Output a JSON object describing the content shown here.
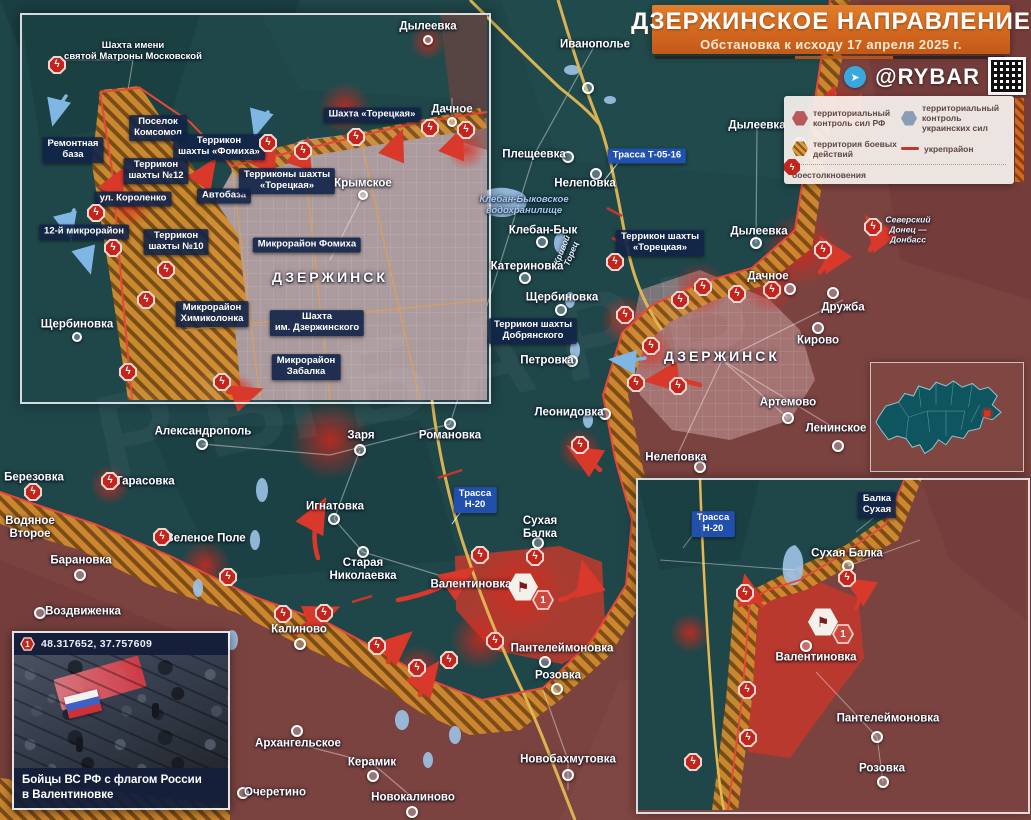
{
  "header": {
    "title": "ДЗЕРЖИНСКОЕ НАПРАВЛЕНИЕ",
    "subtitle": "Обстановка к исходу 17 апреля 2025 г.",
    "brand": "@RYBAR",
    "telegram_icon": "➤"
  },
  "colors": {
    "rf_zone": "#7b4340",
    "ua_zone": "#1d4346",
    "battle_zone": "#d28c2e",
    "clash_red": "#c3251c",
    "chip_navy": "#112348",
    "road_blue": "#2250b2",
    "banner_orange": "#d2671f"
  },
  "legend": {
    "rf": "территориальный контроль сил РФ",
    "ua": "территориальный контроль украинских сил",
    "battle": "территория боевых действий",
    "fort": "укрепрайон",
    "clash": "боестолкновения",
    "bolt": "ϟ"
  },
  "watermark": "РЫБАРЬ",
  "main_map": {
    "labels": [
      {
        "t": "Иванополье",
        "x": 595,
        "y": 45,
        "k": "town"
      },
      {
        "t": "Дылеевка",
        "x": 757,
        "y": 126,
        "k": "town"
      },
      {
        "t": "Трасса Т-05-16",
        "x": 647,
        "y": 156,
        "k": "road"
      },
      {
        "t": "Плещеевка",
        "x": 534,
        "y": 155,
        "k": "town"
      },
      {
        "t": "Нелеповка",
        "x": 585,
        "y": 184,
        "k": "town"
      },
      {
        "t": "Клебан-Быковское\nводохранилище",
        "x": 524,
        "y": 206,
        "k": "riverb"
      },
      {
        "t": "Клебан-Бык",
        "x": 543,
        "y": 231,
        "k": "town"
      },
      {
        "t": "Кривой\nТорец",
        "x": 567,
        "y": 252,
        "k": "river",
        "r": -68
      },
      {
        "t": "Катериновка",
        "x": 527,
        "y": 267,
        "k": "town"
      },
      {
        "t": "Щербиновка",
        "x": 562,
        "y": 298,
        "k": "town"
      },
      {
        "t": "Террикон шахты\nДобрянского",
        "x": 533,
        "y": 331,
        "k": "chip"
      },
      {
        "t": "Петровка",
        "x": 547,
        "y": 361,
        "k": "town"
      },
      {
        "t": "Террикон шахты\n«Торецкая»",
        "x": 660,
        "y": 243,
        "k": "chip"
      },
      {
        "t": "Дылеевка",
        "x": 759,
        "y": 232,
        "k": "town"
      },
      {
        "t": "Дачное",
        "x": 768,
        "y": 277,
        "k": "town"
      },
      {
        "t": "Северский\nДонец —\nДонбасс",
        "x": 908,
        "y": 230,
        "k": "river"
      },
      {
        "t": "ДЗЕРЖИНСК",
        "x": 722,
        "y": 356,
        "k": "caps"
      },
      {
        "t": "Дружба",
        "x": 843,
        "y": 308,
        "k": "town"
      },
      {
        "t": "Кирово",
        "x": 818,
        "y": 341,
        "k": "town"
      },
      {
        "t": "Артемово",
        "x": 788,
        "y": 403,
        "k": "town"
      },
      {
        "t": "Ленинское",
        "x": 836,
        "y": 429,
        "k": "town"
      },
      {
        "t": "Леонидовка",
        "x": 569,
        "y": 413,
        "k": "town"
      },
      {
        "t": "Нелеповка",
        "x": 676,
        "y": 458,
        "k": "town"
      },
      {
        "t": "Александрополь",
        "x": 203,
        "y": 432,
        "k": "town"
      },
      {
        "t": "Березовка",
        "x": 34,
        "y": 478,
        "k": "town"
      },
      {
        "t": "Тарасовка",
        "x": 145,
        "y": 482,
        "k": "town"
      },
      {
        "t": "Водяное\nВторое",
        "x": 30,
        "y": 528,
        "k": "town"
      },
      {
        "t": "Зеленое Поле",
        "x": 206,
        "y": 539,
        "k": "town"
      },
      {
        "t": "Барановка",
        "x": 81,
        "y": 561,
        "k": "town"
      },
      {
        "t": "Воздвиженка",
        "x": 83,
        "y": 612,
        "k": "town"
      },
      {
        "t": "Заря",
        "x": 361,
        "y": 436,
        "k": "town"
      },
      {
        "t": "Романовка",
        "x": 450,
        "y": 436,
        "k": "town"
      },
      {
        "t": "Трасса\nН-20",
        "x": 475,
        "y": 500,
        "k": "road"
      },
      {
        "t": "Игнатовка",
        "x": 335,
        "y": 507,
        "k": "town"
      },
      {
        "t": "Сухая\nБалка",
        "x": 540,
        "y": 528,
        "k": "town"
      },
      {
        "t": "Старая\nНиколаевка",
        "x": 363,
        "y": 570,
        "k": "town"
      },
      {
        "t": "Валентиновка",
        "x": 471,
        "y": 585,
        "k": "town"
      },
      {
        "t": "Пантелеймоновка",
        "x": 562,
        "y": 649,
        "k": "town"
      },
      {
        "t": "Калиново",
        "x": 299,
        "y": 630,
        "k": "town"
      },
      {
        "t": "Розовка",
        "x": 558,
        "y": 676,
        "k": "town"
      },
      {
        "t": "Архангельское",
        "x": 298,
        "y": 744,
        "k": "town"
      },
      {
        "t": "Керамик",
        "x": 372,
        "y": 763,
        "k": "town"
      },
      {
        "t": "Очеретино",
        "x": 275,
        "y": 793,
        "k": "town"
      },
      {
        "t": "Новокалиново",
        "x": 413,
        "y": 798,
        "k": "town"
      },
      {
        "t": "Новобахмутовка",
        "x": 568,
        "y": 760,
        "k": "town"
      }
    ],
    "dots": [
      [
        588,
        88
      ],
      [
        800,
        143
      ],
      [
        568,
        157
      ],
      [
        596,
        174
      ],
      [
        542,
        242
      ],
      [
        525,
        278
      ],
      [
        561,
        310
      ],
      [
        572,
        361
      ],
      [
        605,
        414
      ],
      [
        700,
        467
      ],
      [
        790,
        289
      ],
      [
        756,
        243
      ],
      [
        833,
        293
      ],
      [
        818,
        328
      ],
      [
        788,
        418
      ],
      [
        838,
        446
      ],
      [
        202,
        444
      ],
      [
        360,
        450
      ],
      [
        450,
        424
      ],
      [
        334,
        519
      ],
      [
        538,
        543
      ],
      [
        363,
        552
      ],
      [
        300,
        644
      ],
      [
        557,
        689
      ],
      [
        297,
        731
      ],
      [
        373,
        776
      ],
      [
        243,
        793
      ],
      [
        412,
        812
      ],
      [
        568,
        775
      ],
      [
        80,
        575
      ],
      [
        40,
        613
      ],
      [
        545,
        662
      ]
    ],
    "clashes": [
      [
        615,
        262
      ],
      [
        625,
        315
      ],
      [
        651,
        346
      ],
      [
        680,
        300
      ],
      [
        703,
        287
      ],
      [
        737,
        294
      ],
      [
        772,
        290
      ],
      [
        823,
        250
      ],
      [
        873,
        227
      ],
      [
        636,
        383
      ],
      [
        678,
        386
      ],
      [
        580,
        445
      ],
      [
        33,
        492
      ],
      [
        110,
        481
      ],
      [
        162,
        537
      ],
      [
        228,
        577
      ],
      [
        283,
        614
      ],
      [
        324,
        613
      ],
      [
        377,
        646
      ],
      [
        417,
        668
      ],
      [
        449,
        660
      ],
      [
        495,
        641
      ],
      [
        480,
        555
      ],
      [
        535,
        557
      ]
    ],
    "flag_marker": {
      "x": 523,
      "y": 587,
      "glyph": "⚑"
    },
    "num_marker": {
      "x": 543,
      "y": 600,
      "t": "1"
    }
  },
  "inset_city": {
    "labels": [
      {
        "t": "Шахта имени\nсвятой Матроны Московской",
        "x": 133,
        "y": 52,
        "k": "townsm"
      },
      {
        "t": "Поселок\nКомсомол",
        "x": 158,
        "y": 128,
        "k": "chip"
      },
      {
        "t": "Ремонтная\nбаза",
        "x": 73,
        "y": 150,
        "k": "chip"
      },
      {
        "t": "Террикон\nшахты «Фомиха»",
        "x": 219,
        "y": 147,
        "k": "chip"
      },
      {
        "t": "Террикон\nшахты №12",
        "x": 156,
        "y": 171,
        "k": "chip"
      },
      {
        "t": "ул. Короленко",
        "x": 133,
        "y": 199,
        "k": "chip"
      },
      {
        "t": "Автобаза",
        "x": 224,
        "y": 196,
        "k": "chip"
      },
      {
        "t": "12-й микрорайон",
        "x": 84,
        "y": 232,
        "k": "chip"
      },
      {
        "t": "Террикон\nшахты №10",
        "x": 176,
        "y": 242,
        "k": "chip"
      },
      {
        "t": "Терриконы шахты\n«Торецкая»",
        "x": 287,
        "y": 181,
        "k": "chip"
      },
      {
        "t": "Шахта «Торецкая»",
        "x": 372,
        "y": 115,
        "k": "chip"
      },
      {
        "t": "Микрорайон Фомиха",
        "x": 307,
        "y": 245,
        "k": "chip"
      },
      {
        "t": "Крымское",
        "x": 363,
        "y": 184,
        "k": "town"
      },
      {
        "t": "Дачное",
        "x": 452,
        "y": 110,
        "k": "town"
      },
      {
        "t": "Дылеевка",
        "x": 428,
        "y": 27,
        "k": "town"
      },
      {
        "t": "Щербиновка",
        "x": 77,
        "y": 325,
        "k": "town"
      },
      {
        "t": "Микрорайон\nХимиколонка",
        "x": 212,
        "y": 314,
        "k": "chip"
      },
      {
        "t": "Шахта\nим. Дзержинского",
        "x": 317,
        "y": 323,
        "k": "chip"
      },
      {
        "t": "Микрорайон\nЗабалка",
        "x": 306,
        "y": 367,
        "k": "chip"
      },
      {
        "t": "ДЗЕРЖИНСК",
        "x": 330,
        "y": 277,
        "k": "caps"
      }
    ],
    "dots": [
      [
        363,
        195
      ],
      [
        452,
        122
      ],
      [
        428,
        40
      ],
      [
        77,
        337
      ]
    ],
    "clashes": [
      [
        57,
        65
      ],
      [
        268,
        143
      ],
      [
        303,
        151
      ],
      [
        356,
        137
      ],
      [
        430,
        128
      ],
      [
        466,
        130
      ],
      [
        166,
        270
      ],
      [
        146,
        300
      ],
      [
        128,
        372
      ],
      [
        222,
        382
      ],
      [
        96,
        213
      ],
      [
        113,
        248
      ]
    ]
  },
  "inset_se": {
    "labels": [
      {
        "t": "Трасса\nН-20",
        "x": 713,
        "y": 524,
        "k": "road"
      },
      {
        "t": "Балка\nСухая",
        "x": 877,
        "y": 505,
        "k": "chip"
      },
      {
        "t": "Сухая Балка",
        "x": 847,
        "y": 554,
        "k": "town"
      },
      {
        "t": "Валентиновка",
        "x": 816,
        "y": 658,
        "k": "town"
      },
      {
        "t": "Пантелеймоновка",
        "x": 888,
        "y": 719,
        "k": "town"
      },
      {
        "t": "Розовка",
        "x": 882,
        "y": 769,
        "k": "town"
      }
    ],
    "dots": [
      [
        848,
        566
      ],
      [
        877,
        737
      ],
      [
        883,
        782
      ],
      [
        806,
        646
      ]
    ],
    "clashes": [
      [
        745,
        593
      ],
      [
        847,
        578
      ],
      [
        747,
        690
      ],
      [
        748,
        738
      ],
      [
        693,
        762
      ]
    ],
    "flag_marker": {
      "x": 823,
      "y": 622,
      "glyph": "⚑"
    },
    "num_marker": {
      "x": 843,
      "y": 634,
      "t": "1"
    }
  },
  "photo": {
    "num": "1",
    "coords": "48.317652, 37.757609",
    "caption": "Бойцы ВС РФ с флагом России\nв Валентиновке"
  }
}
